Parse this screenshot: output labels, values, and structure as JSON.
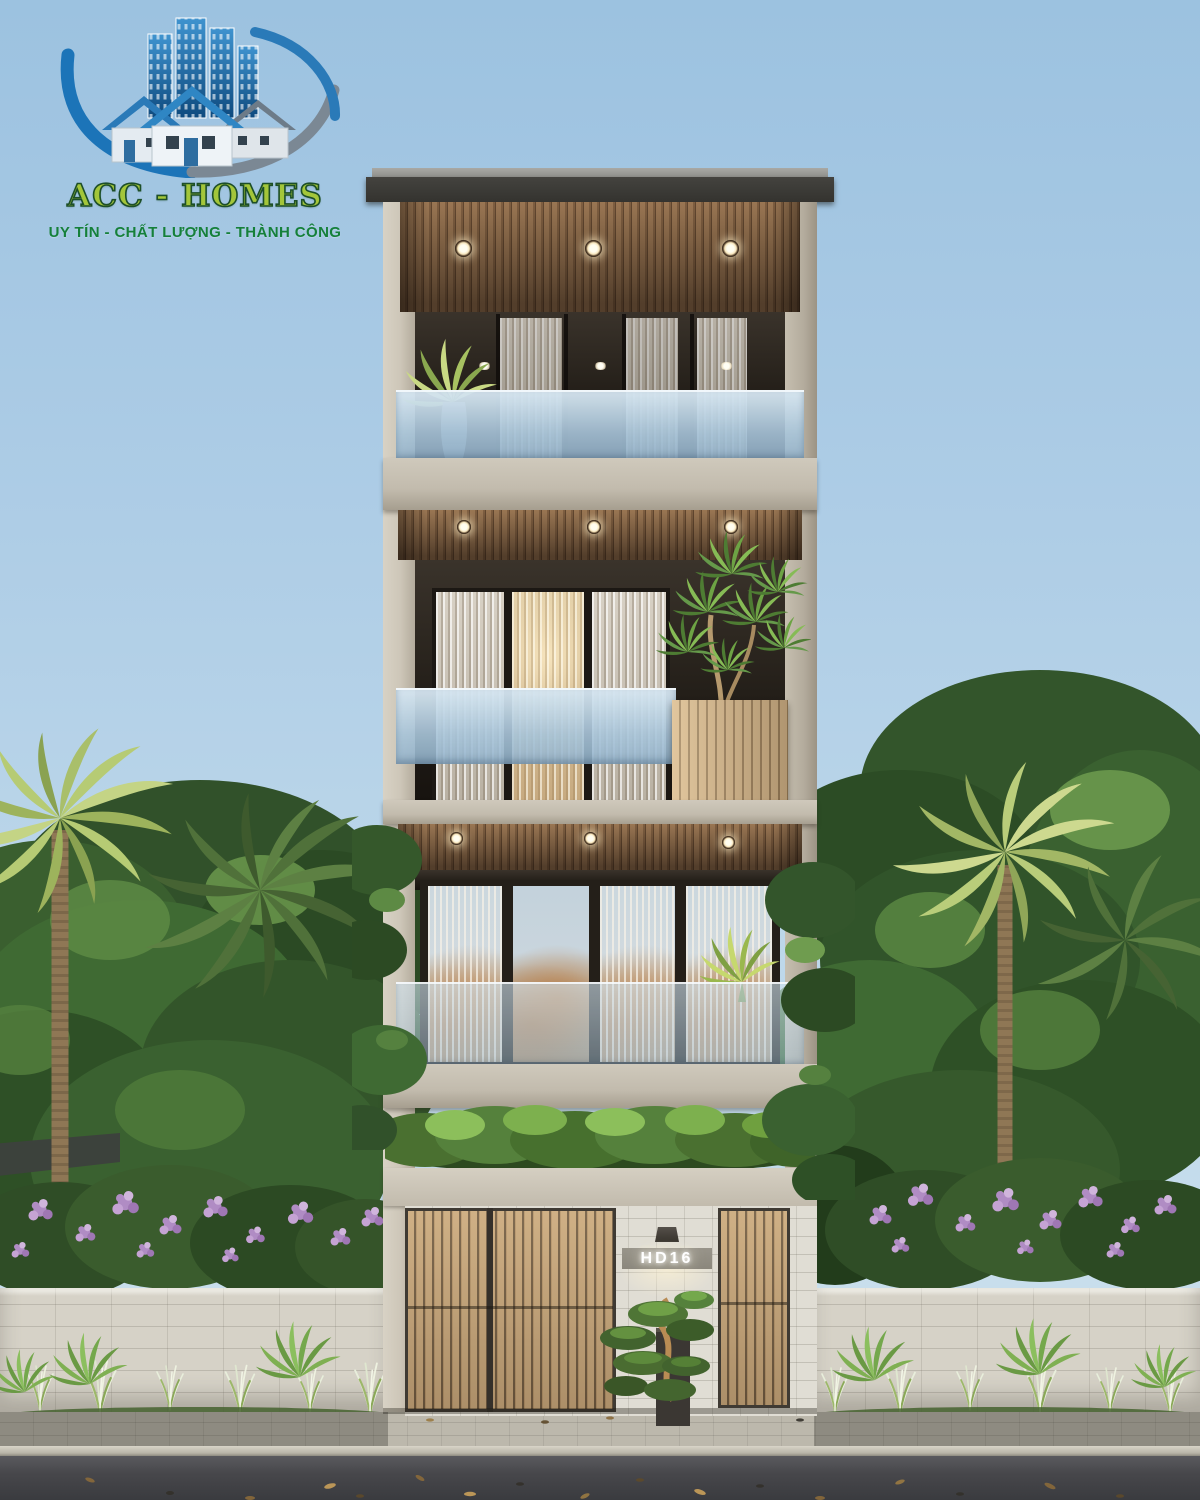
{
  "watermark": {
    "brand": "ACC - HOMES",
    "tagline": "UY TÍN - CHẤT LƯỢNG - THÀNH CÔNG"
  },
  "building": {
    "house_number": "HD16"
  },
  "icons": [
    "buildings-icon",
    "houses-icon",
    "swoosh-icon",
    "wall-lamp-icon",
    "ceiling-downlight"
  ],
  "palette": {
    "sky_top": "#9cc2e0",
    "sky_bottom": "#cfe2ee",
    "wood_soffit": "#7c5e42",
    "gate_wood": "#c9a87c",
    "concrete": "#cdc6b8",
    "stone_facade": "#e0ddd4",
    "fence_stone": "#d6d2c7",
    "glass_railing": "#a8c5da",
    "foliage_dark": "#31512a",
    "foliage_light": "#6f9c4f",
    "flower_purple": "#b08cc4",
    "asphalt": "#47474b",
    "logo_green_text": "#a3c63a",
    "logo_tagline_green": "#15803a",
    "logo_blue": "#1c74b8",
    "number_band": "#8f8b80"
  }
}
